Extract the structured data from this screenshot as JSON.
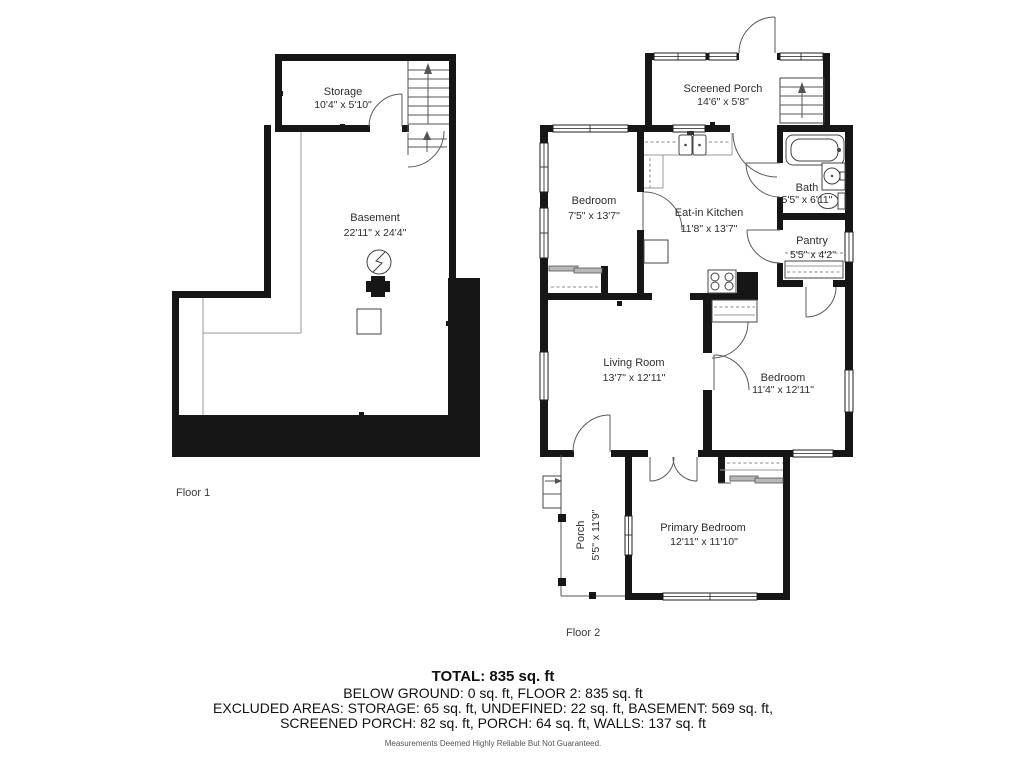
{
  "floor1": {
    "label": "Floor 1",
    "rooms": {
      "storage": {
        "name": "Storage",
        "dims": "10'4\" x 5'10\""
      },
      "basement": {
        "name": "Basement",
        "dims": "22'11\" x 24'4\""
      }
    }
  },
  "floor2": {
    "label": "Floor 2",
    "rooms": {
      "screened_porch": {
        "name": "Screened Porch",
        "dims": "14'6\" x 5'8\""
      },
      "bedroom1": {
        "name": "Bedroom",
        "dims": "7'5\" x 13'7\""
      },
      "kitchen": {
        "name": "Eat-in Kitchen",
        "dims": "11'8\" x 13'7\""
      },
      "bath": {
        "name": "Bath",
        "dims": "5'5\" x 6'11\""
      },
      "pantry": {
        "name": "Pantry",
        "dims": "5'5\" x 4'2\""
      },
      "living": {
        "name": "Living Room",
        "dims": "13'7\" x 12'11\""
      },
      "bedroom2": {
        "name": "Bedroom",
        "dims": "11'4\" x 12'11\""
      },
      "porch": {
        "name": "Porch",
        "dims": "5'5\" x 11'9\""
      },
      "primary": {
        "name": "Primary Bedroom",
        "dims": "12'11\" x 11'10\""
      }
    }
  },
  "summary": {
    "total": "TOTAL: 835 sq. ft",
    "line2": "BELOW GROUND: 0 sq. ft, FLOOR 2: 835 sq. ft",
    "line3": "EXCLUDED AREAS: STORAGE: 65 sq. ft, UNDEFINED: 22 sq. ft, BASEMENT: 569 sq. ft,",
    "line4": "SCREENED PORCH: 82 sq. ft, PORCH: 64 sq. ft, WALLS: 137 sq. ft",
    "disclaimer": "Measurements Deemed Highly Reliable But Not Guaranteed."
  },
  "colors": {
    "wall": "#161616",
    "line": "#555555",
    "accent_gray": "#b8b8b8"
  }
}
